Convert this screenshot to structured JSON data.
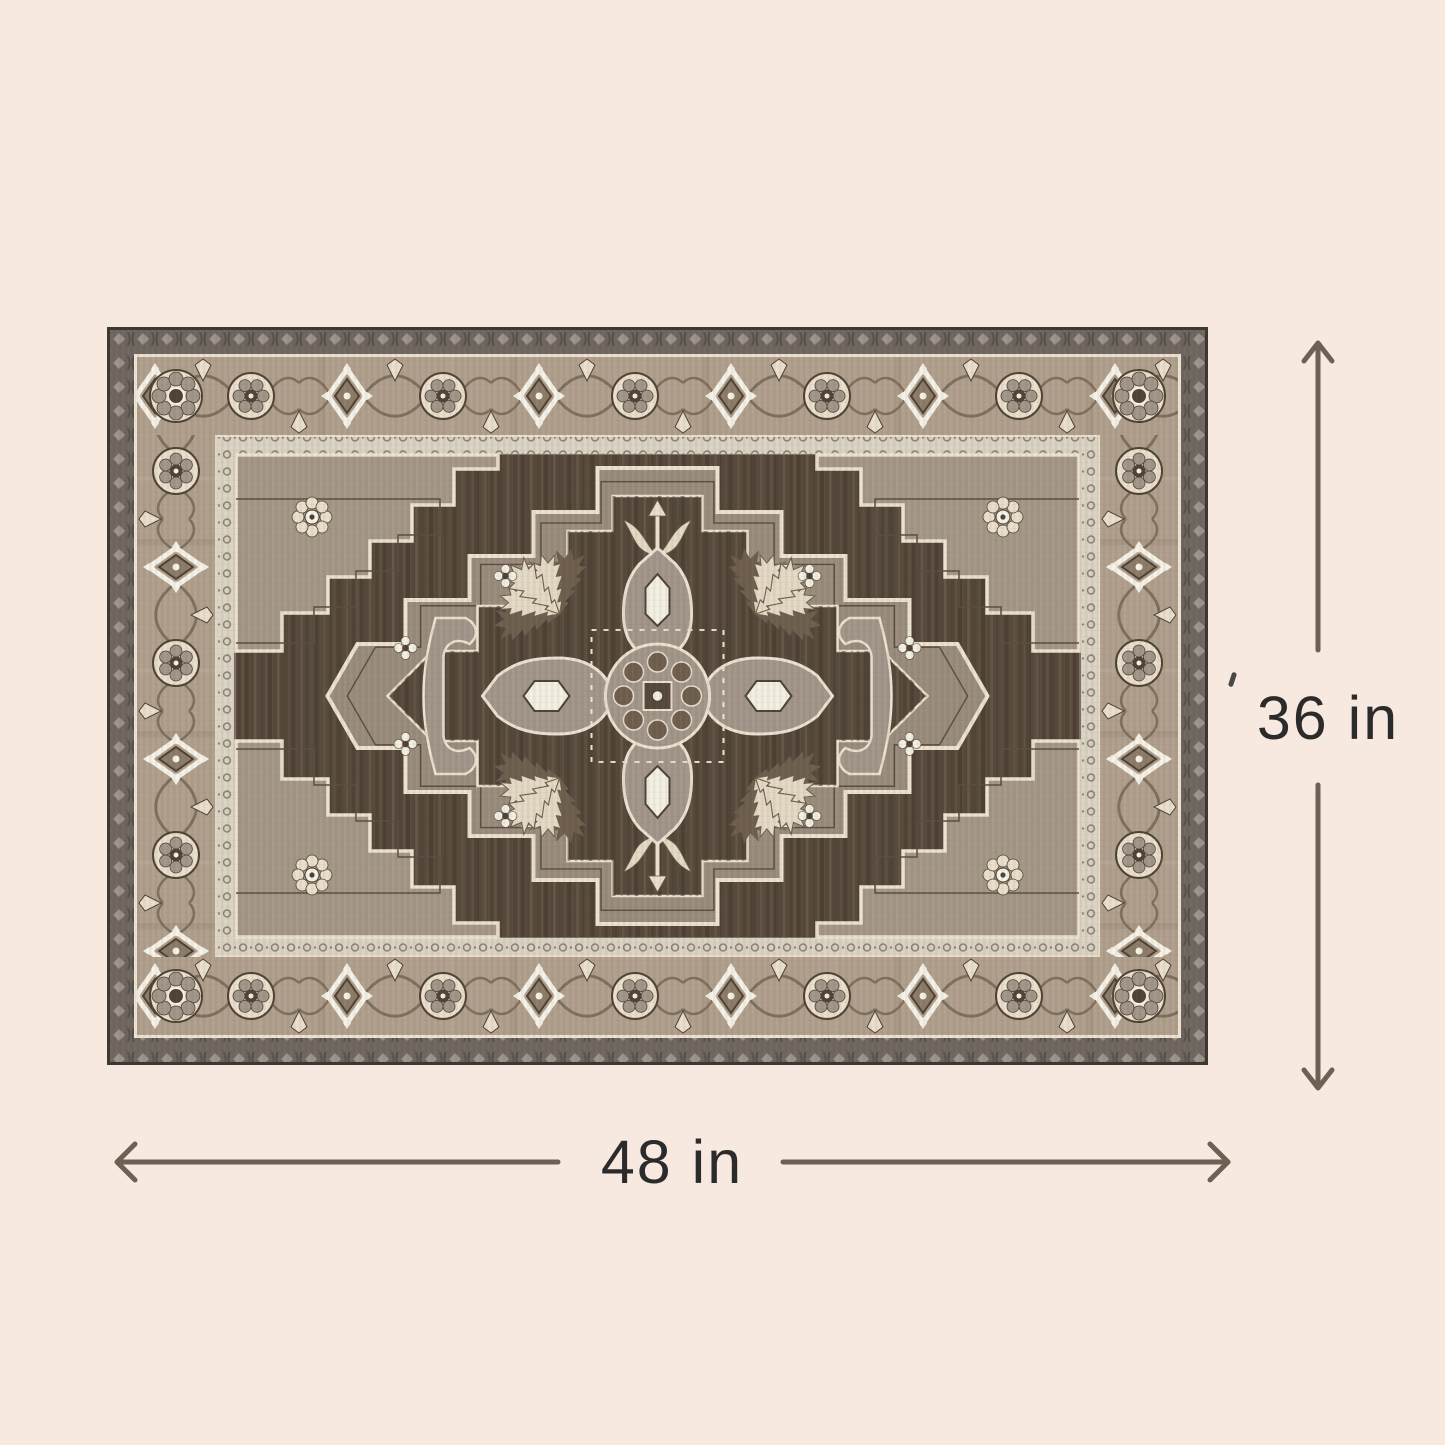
{
  "image": {
    "alt": "Vintage Persian-style medallion area rug in brown, taupe and cream shown flat with measurement arrows"
  },
  "dimensions": {
    "height": {
      "label": "36 in",
      "value": 36,
      "unit": "in",
      "orientation": "vertical"
    },
    "width": {
      "label": "48 in",
      "value": 48,
      "unit": "in",
      "orientation": "horizontal"
    }
  },
  "icons": {
    "height_arrow": "vertical-double-ended-arrow",
    "width_arrow": "horizontal-double-ended-arrow"
  },
  "colors": {
    "background": "#f8e9e0",
    "dim_line": "#6e6054",
    "dim_text": "#2b2b2b",
    "rug_edge": "#3f3830",
    "guard_band": "#6f6760",
    "guard_motif": "#9c958b",
    "guard_dark": "#56504a",
    "border_ground": "#b1a08d",
    "motif_cream": "#e9dfcc",
    "motif_white": "#f6f2e8",
    "motif_dark": "#4f4335",
    "vine": "#80705e",
    "inner_guard": "#dbd3c3",
    "inner_guard_mark": "#8f8679",
    "field": "#57493c",
    "field_streak_dark": "#453a2f",
    "field_streak_light": "#7a6a57",
    "spandrel": "#a69888",
    "medallion": "#9a8d7e",
    "medallion_line": "#ece2d0",
    "medallion_echo": "#5c4e41",
    "arm": "#a3968a",
    "hex_white": "#f4efe3",
    "leaf_cream": "#e4d9c5",
    "leaf_dark": "#6f5f4e"
  }
}
